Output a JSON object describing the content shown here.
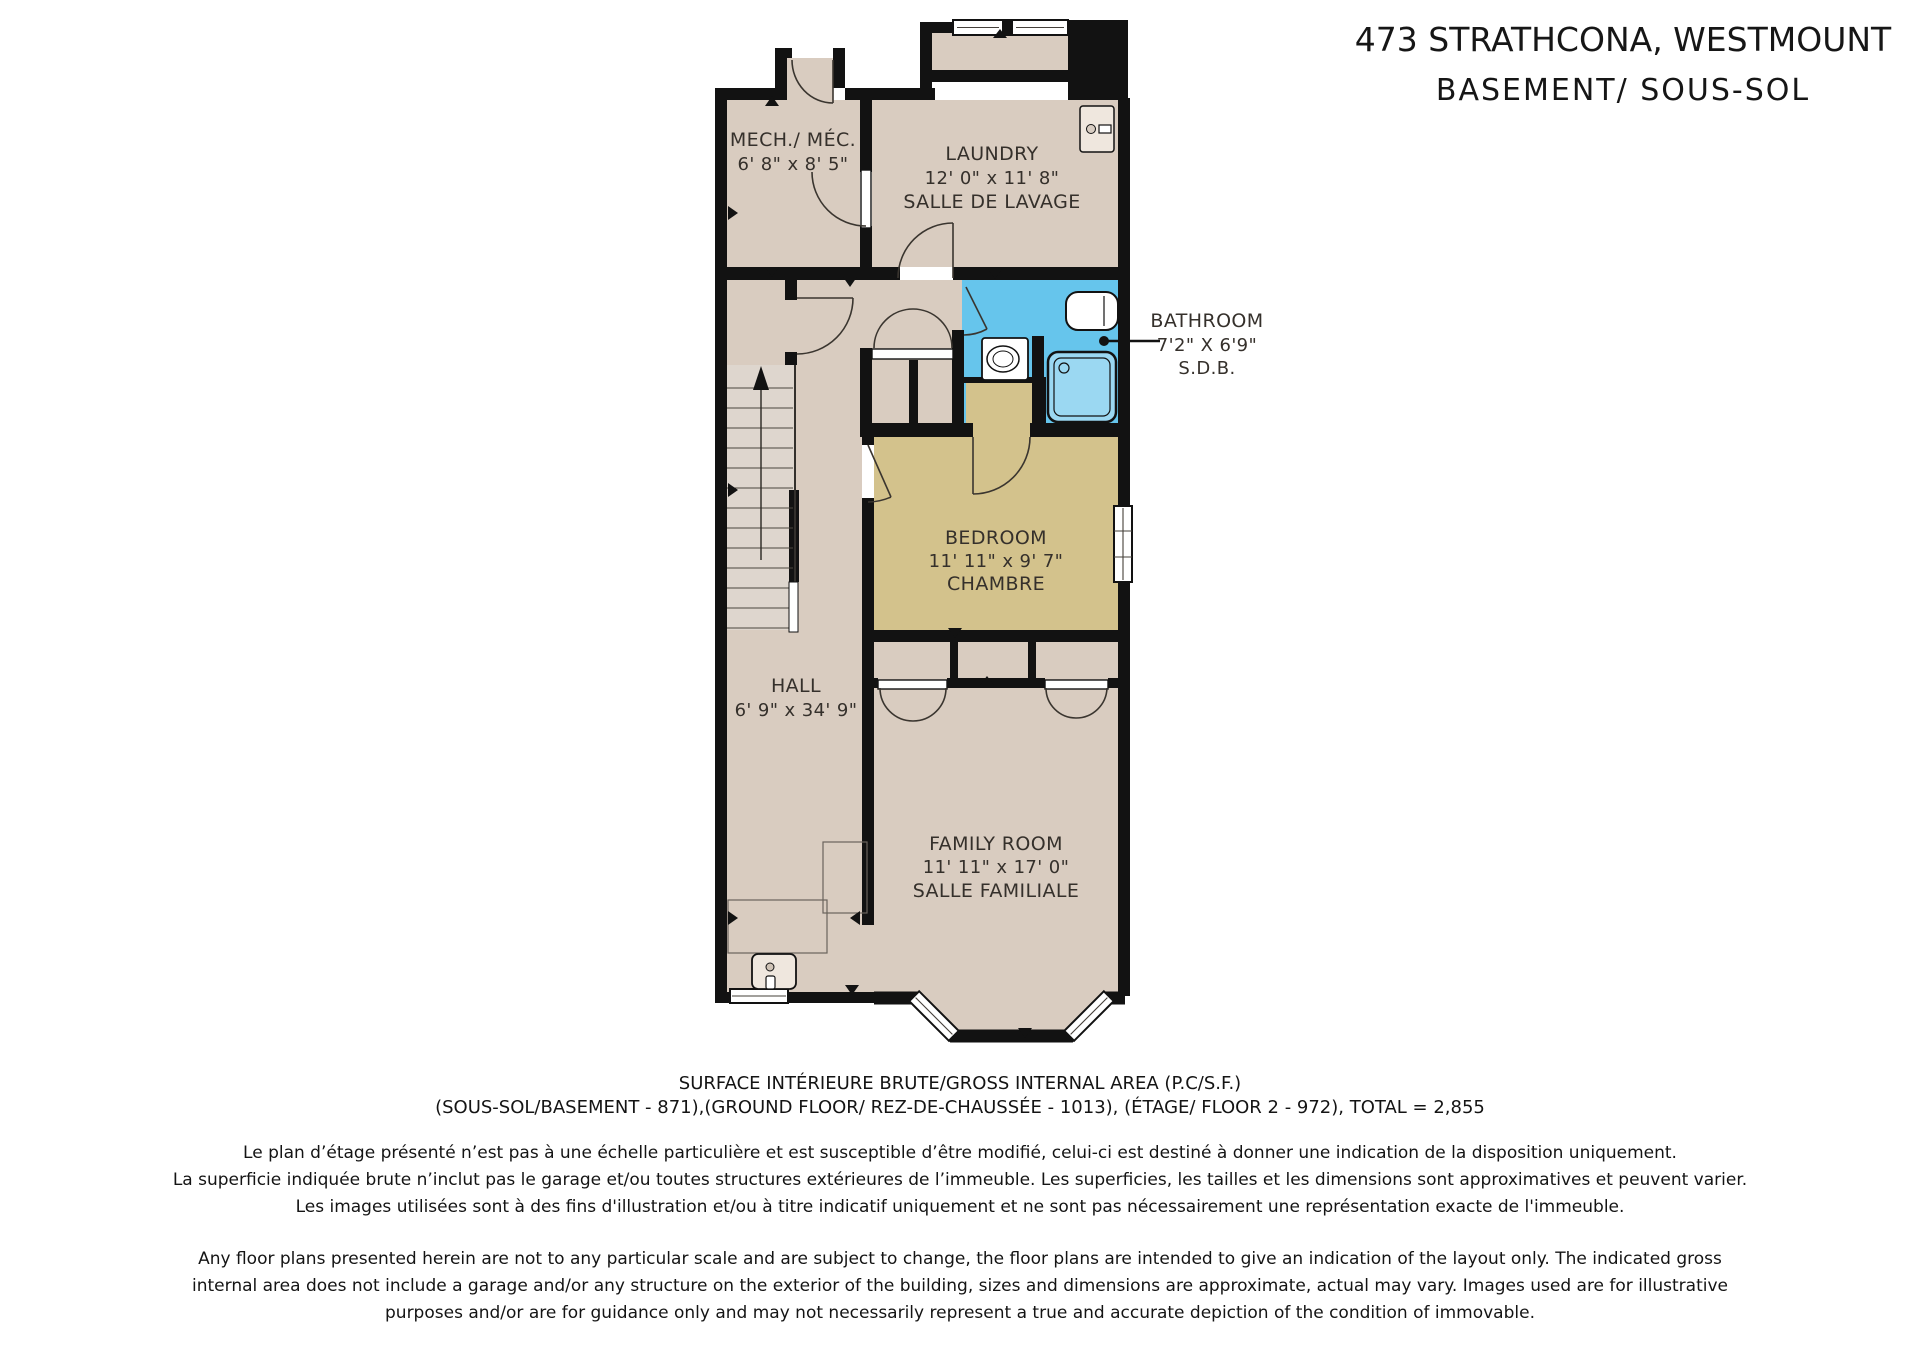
{
  "title": {
    "line1": "473 STRATHCONA, WESTMOUNT",
    "line2": "BASEMENT/ SOUS-SOL"
  },
  "plan": {
    "mech": {
      "name": "MECH./ MÉC.",
      "dims": "6' 8\" x 8' 5\""
    },
    "laundry": {
      "name": "LAUNDRY",
      "dims": "12' 0\" x 11' 8\"",
      "subtitle": "SALLE DE LAVAGE"
    },
    "bathroom": {
      "name": "BATHROOM",
      "dims": "7'2\" X 6'9\"",
      "subtitle": "S.D.B."
    },
    "bedroom": {
      "name": "BEDROOM",
      "dims": "11' 11\" x 9' 7\"",
      "subtitle": "CHAMBRE"
    },
    "hall": {
      "name": "HALL",
      "dims": "6' 9\" x 34' 9\""
    },
    "family": {
      "name": "FAMILY ROOM",
      "dims": "11' 11\" x 17' 0\"",
      "subtitle": "SALLE FAMILIALE"
    }
  },
  "footer": {
    "surface1": "SURFACE INTÉRIEURE BRUTE/GROSS INTERNAL AREA (P.C/S.F.)",
    "surface2": "(SOUS-SOL/BASEMENT - 871),(GROUND FLOOR/ REZ-DE-CHAUSSÉE - 1013), (ÉTAGE/ FLOOR 2 - 972), TOTAL = 2,855",
    "fr": [
      "Le plan d’étage présenté n’est pas à une échelle particulière et est susceptible d’être modifié, celui-ci est destiné à donner une indication de la disposition uniquement.",
      "La superficie indiquée brute n’inclut pas le garage et/ou toutes structures extérieures de l’immeuble. Les superficies, les tailles et les dimensions sont approximatives et peuvent varier.",
      "Les images utilisées sont à des fins d'illustration et/ou à titre indicatif uniquement et ne sont pas nécessairement une représentation exacte de l'immeuble."
    ],
    "en": [
      "Any floor plans presented herein are not to any particular scale and are subject to change, the floor plans are intended to give an indication of the layout only. The indicated gross",
      "internal area does not include a garage and/or any structure on the exterior of the building, sizes and dimensions are approximate, actual may vary. Images used are for illustrative",
      "purposes and/or are for guidance only and may not necessarily represent a true and accurate depiction of the condition of immovable."
    ]
  },
  "colors": {
    "floor": "#d9ccc0",
    "stair": "#ded6ce",
    "bedroom": "#d3c28c",
    "bathroom": "#66c5ec",
    "shower": "#9bd8f2",
    "wall": "#121212",
    "label": "#35302b"
  }
}
